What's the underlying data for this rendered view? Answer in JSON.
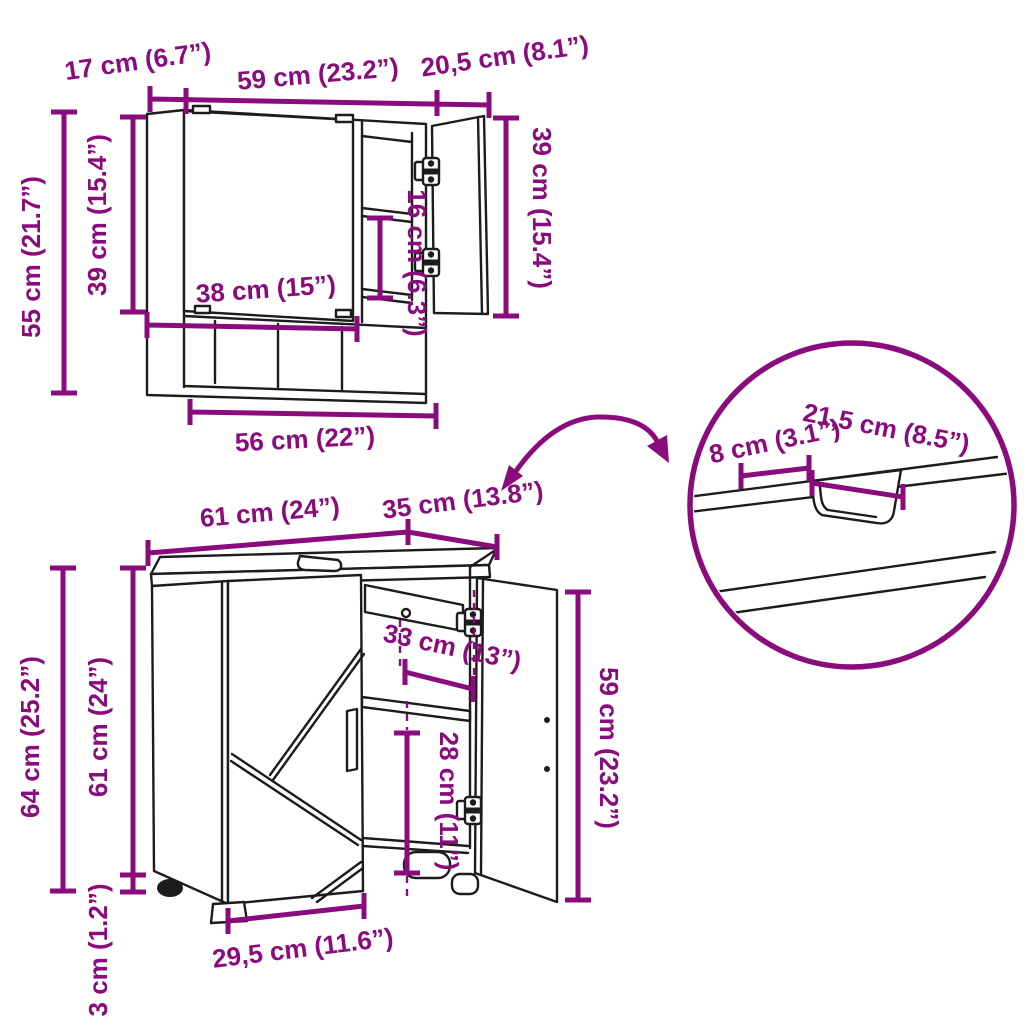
{
  "colors": {
    "dimension_accent": "#8a0b7c",
    "line_art": "#1c1c1c",
    "background": "#ffffff"
  },
  "measurements": {
    "mirror_cabinet": {
      "top_depth": "17 cm (6.7”)",
      "top_width": "59 cm (23.2”)",
      "open_door_width": "20,5 cm (8.1”)",
      "height_total": "55 cm (21.7”)",
      "height_body": "39 cm (15.4”)",
      "height_door": "39 cm (15.4”)",
      "shelf_spacing": "16 cm (6.3”)",
      "shelf_width": "38 cm (15”)",
      "base_width": "56 cm (22”)"
    },
    "sink_cabinet": {
      "top_width": "61 cm (24”)",
      "top_depth": "35 cm (13.8”)",
      "height_total": "64 cm (25.2”)",
      "height_body": "61 cm (24”)",
      "height_feet": "3 cm (1.2”)",
      "opening_width": "33 cm (13”)",
      "opening_height": "28 cm (11”)",
      "door_height": "59 cm (23.2”)",
      "base_width": "29,5 cm (11.6”)"
    },
    "countertop_detail": {
      "edge_to_cutout": "8 cm (3.1”)",
      "cutout_length": "21,5 cm (8.5”)"
    }
  }
}
